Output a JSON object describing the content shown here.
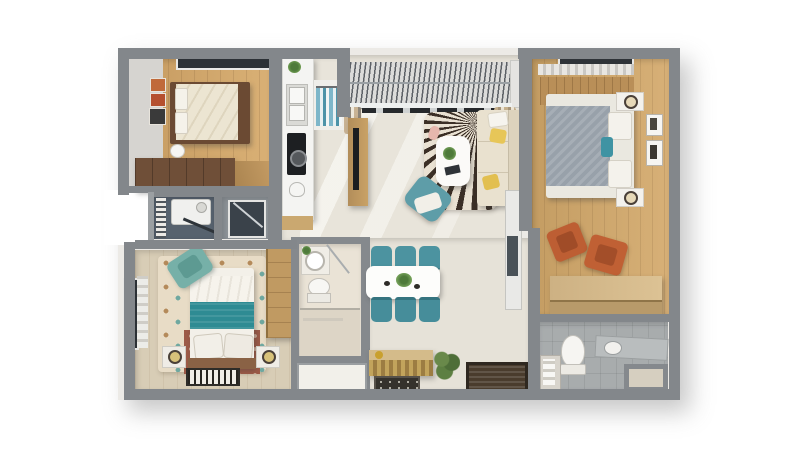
{
  "meta": {
    "type": "3d-floor-plan-render",
    "description": "Top-down 3D architectural render of an apartment: two bedrooms, master bedroom, living room, kitchen, dining area, balcony and three bathroom/laundry zones. No visible text in the image.",
    "canvas_background": "#ffffff"
  },
  "palette": {
    "wall": "#83878b",
    "wall_light": "#9b9fa2",
    "wood_floor": "#c59a60",
    "wood_floor_light": "#d9b075",
    "open_floor": "#e8e4da",
    "bath_tile": "#a8acad",
    "dark_bath_floor": "#57626e",
    "teal_chair": "#4c93a0",
    "teal_blanket": "#2e8b93",
    "orange_chair": "#bf5f33",
    "yellow_pillow": "#e7c658",
    "cream_sofa": "#e9e1cf",
    "gray_duvet": "#98a1aa",
    "rug_dark": "#3b2f26",
    "rug_cream": "#e9e1d2",
    "furniture_wood": "#b28d5a",
    "sideboard_gold": "#c2a45c",
    "doormat_brown": "#4a3c2d"
  },
  "rooms": [
    {
      "id": "bedroom-1",
      "label": "Top-left bedroom: double bed with cream duvet, wall art frames, window, dark wood wardrobe"
    },
    {
      "id": "kitchen",
      "label": "Galley kitchen strip: white counter with sink, cooktop, plant; closet with blue clothes"
    },
    {
      "id": "laundry-bathroom",
      "label": "Middle utility bathroom: washing machine, drying rack, glass shower"
    },
    {
      "id": "balcony",
      "label": "Balcony with louvered pergola roof and sliding door"
    },
    {
      "id": "living-room",
      "label": "Living room: zebra sunburst rug, white coffee table, cream sofa with yellow pillows, teal bean bag, TV console, coat rack"
    },
    {
      "id": "master-bedroom",
      "label": "Master bedroom: gray double bed, nightstands with lamps, wall frames, two orange armchairs, wooden storage bench"
    },
    {
      "id": "master-bathroom",
      "label": "Bottom-right bathroom: toilet, vanity with sink, shelf, storage niche"
    },
    {
      "id": "bedroom-2",
      "label": "Bottom-left bedroom: bed with white and teal bedding, patterned rug, teal armchair, nightstands with lamps, striped mat, wardrobe, window"
    },
    {
      "id": "bathroom-1",
      "label": "Middle bathroom: round basin, toilet, shower zone, storage niche below"
    },
    {
      "id": "dining-area",
      "label": "Dining area: white table with six teal chairs, gold-front sideboard, potted plant, entry doormats"
    }
  ]
}
